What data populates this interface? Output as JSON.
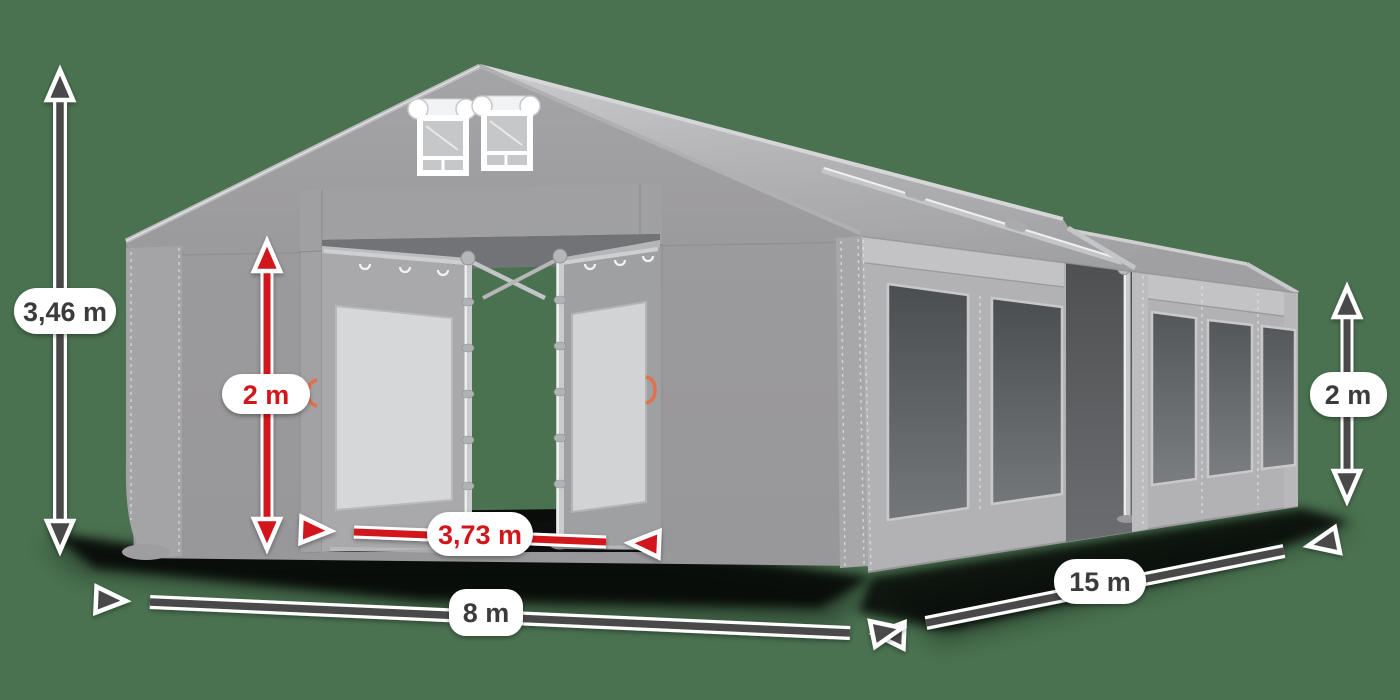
{
  "dimensions": {
    "total_height": {
      "text": "3,46 m",
      "style": "dark"
    },
    "entrance_height": {
      "text": "2 m",
      "style": "red"
    },
    "entrance_width": {
      "text": "3,73 m",
      "style": "red"
    },
    "front_width": {
      "text": "8 m",
      "style": "dark"
    },
    "side_length": {
      "text": "15 m",
      "style": "dark"
    },
    "side_wall_height": {
      "text": "2 m",
      "style": "dark"
    }
  },
  "colors": {
    "background_green": "#4A7150",
    "dimension_red": "#D1151A",
    "dimension_dark": "#48484A",
    "label_background": "#FFFFFF",
    "label_text_dark": "#3B3B3D",
    "tent_fabric_gray": "#9B9A9C",
    "side_wall_gray": "#B2B2B4",
    "roof_highlight": "#C9C9CB",
    "window_dark": "#4B4E50",
    "frame_silver": "#C9CBCD",
    "handle_orange": "#E2714B",
    "shadow_black": "#000000"
  }
}
